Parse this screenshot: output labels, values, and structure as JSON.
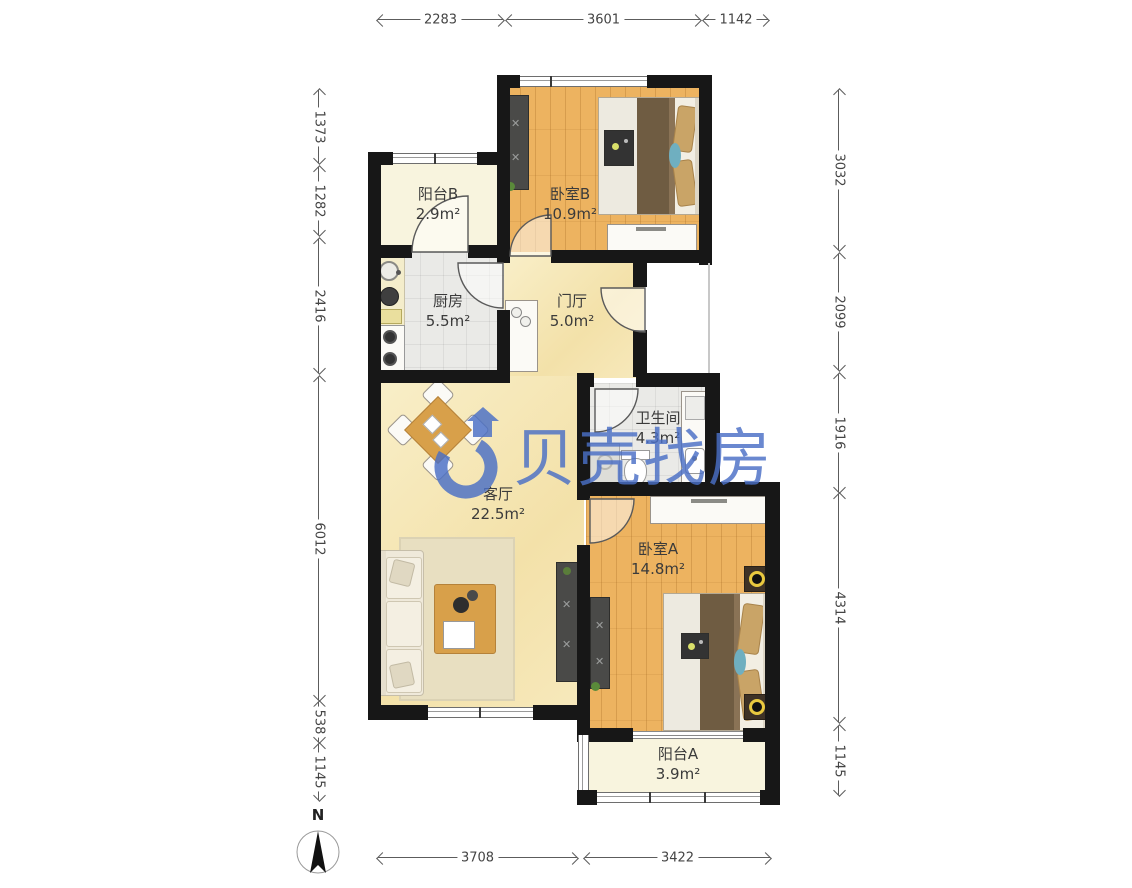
{
  "plan": {
    "rooms": [
      {
        "id": "balcony-b",
        "name": "阳台B",
        "area": "2.9m²"
      },
      {
        "id": "bedroom-b",
        "name": "卧室B",
        "area": "10.9m²"
      },
      {
        "id": "kitchen",
        "name": "厨房",
        "area": "5.5m²"
      },
      {
        "id": "foyer",
        "name": "门厅",
        "area": "5.0m²"
      },
      {
        "id": "bathroom",
        "name": "卫生间",
        "area": "4.3m²"
      },
      {
        "id": "living-room",
        "name": "客厅",
        "area": "22.5m²"
      },
      {
        "id": "bedroom-a",
        "name": "卧室A",
        "area": "14.8m²"
      },
      {
        "id": "balcony-a",
        "name": "阳台A",
        "area": "3.9m²"
      }
    ]
  },
  "dimensions": {
    "top": [
      "2283",
      "3601",
      "1142"
    ],
    "bottom": [
      "3708",
      "3422"
    ],
    "left": [
      "1373",
      "1282",
      "2416",
      "6012",
      "538",
      "1145"
    ],
    "right": [
      "3032",
      "2099",
      "1916",
      "4314",
      "1145"
    ]
  },
  "watermark": {
    "text": "贝壳找房",
    "color": "#4a6fc6"
  },
  "compass": {
    "label": "N"
  },
  "colors": {
    "wall": "#171717",
    "wood_floor": "#EDB360",
    "warm_floor": "#F6E7B6",
    "tile_floor": "#EAEAE7",
    "balcony_floor": "#F8F4DE",
    "watermark_blue": "#4a6fc6",
    "blanket_brown": "#6F5C42",
    "pillow_tan": "#C9A467",
    "pillow_blue": "#6FAFC0",
    "lamp_yellow": "#E9C93F"
  }
}
